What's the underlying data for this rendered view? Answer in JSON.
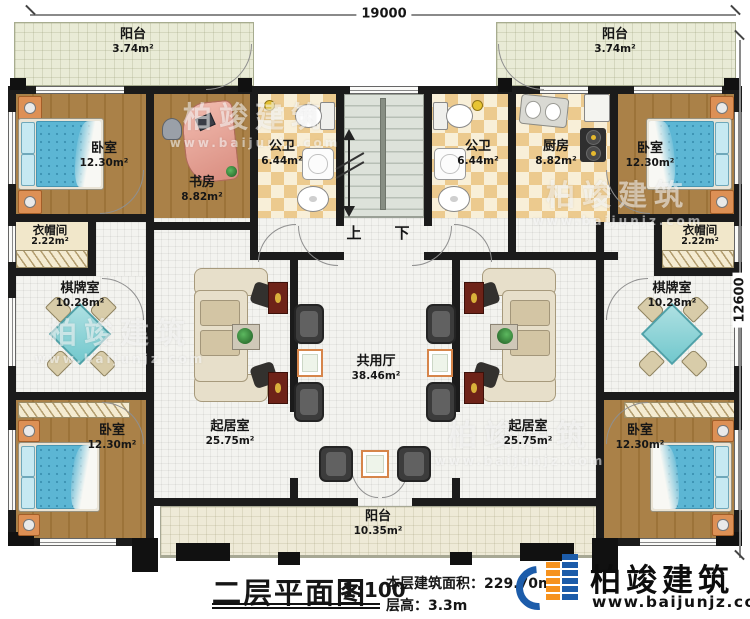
{
  "dimensions": {
    "width_mm": "19000",
    "height_mm": "12600"
  },
  "stairs": {
    "up": "上",
    "down": "下"
  },
  "rooms": {
    "balcony_top_left": {
      "name": "阳台",
      "area": "3.74m²"
    },
    "balcony_top_right": {
      "name": "阳台",
      "area": "3.74m²"
    },
    "bedroom_top_left": {
      "name": "卧室",
      "area": "12.30m²"
    },
    "study": {
      "name": "书房",
      "area": "8.82m²"
    },
    "bath_left": {
      "name": "公卫",
      "area": "6.44m²"
    },
    "bath_right": {
      "name": "公卫",
      "area": "6.44m²"
    },
    "kitchen": {
      "name": "厨房",
      "area": "8.82m²"
    },
    "bedroom_top_right": {
      "name": "卧室",
      "area": "12.30m²"
    },
    "cloakroom_left": {
      "name": "衣帽间",
      "area": "2.22m²"
    },
    "cloakroom_right": {
      "name": "衣帽间",
      "area": "2.22m²"
    },
    "chess_room_left": {
      "name": "棋牌室",
      "area": "10.28m²"
    },
    "chess_room_right": {
      "name": "棋牌室",
      "area": "10.28m²"
    },
    "living_room_left": {
      "name": "起居室",
      "area": "25.75m²"
    },
    "living_room_right": {
      "name": "起居室",
      "area": "25.75m²"
    },
    "shared_hall": {
      "name": "共用厅",
      "area": "38.46m²"
    },
    "bedroom_bottom_left": {
      "name": "卧室",
      "area": "12.30m²"
    },
    "bedroom_bottom_right": {
      "name": "卧室",
      "area": "12.30m²"
    },
    "balcony_bottom": {
      "name": "阳台",
      "area": "10.35m²"
    }
  },
  "title_block": {
    "title": "二层平面图",
    "scale": "1:100",
    "floor_area_label": "本层建筑面积：",
    "floor_area_value": "229.70m²",
    "floor_height_label": "层高：",
    "floor_height_value": "3.3m"
  },
  "branding": {
    "company": "柏竣建筑",
    "website": "www.baijunjz.com"
  },
  "watermark": {
    "text": "柏竣建筑",
    "website": "www.baijunjz.com"
  },
  "colors": {
    "wall": "#1b1b1b",
    "wood_floor": "#a87f47",
    "tile": "#ecca8e",
    "stair": "#d3d9d0",
    "balcony": "#e9ebd6",
    "bed": "#5cb6d4",
    "chess_table": "#8fd4d6",
    "tv_cabinet": "#6e2318",
    "logo_blue": "#1c5caa",
    "logo_orange": "#f6921e"
  }
}
